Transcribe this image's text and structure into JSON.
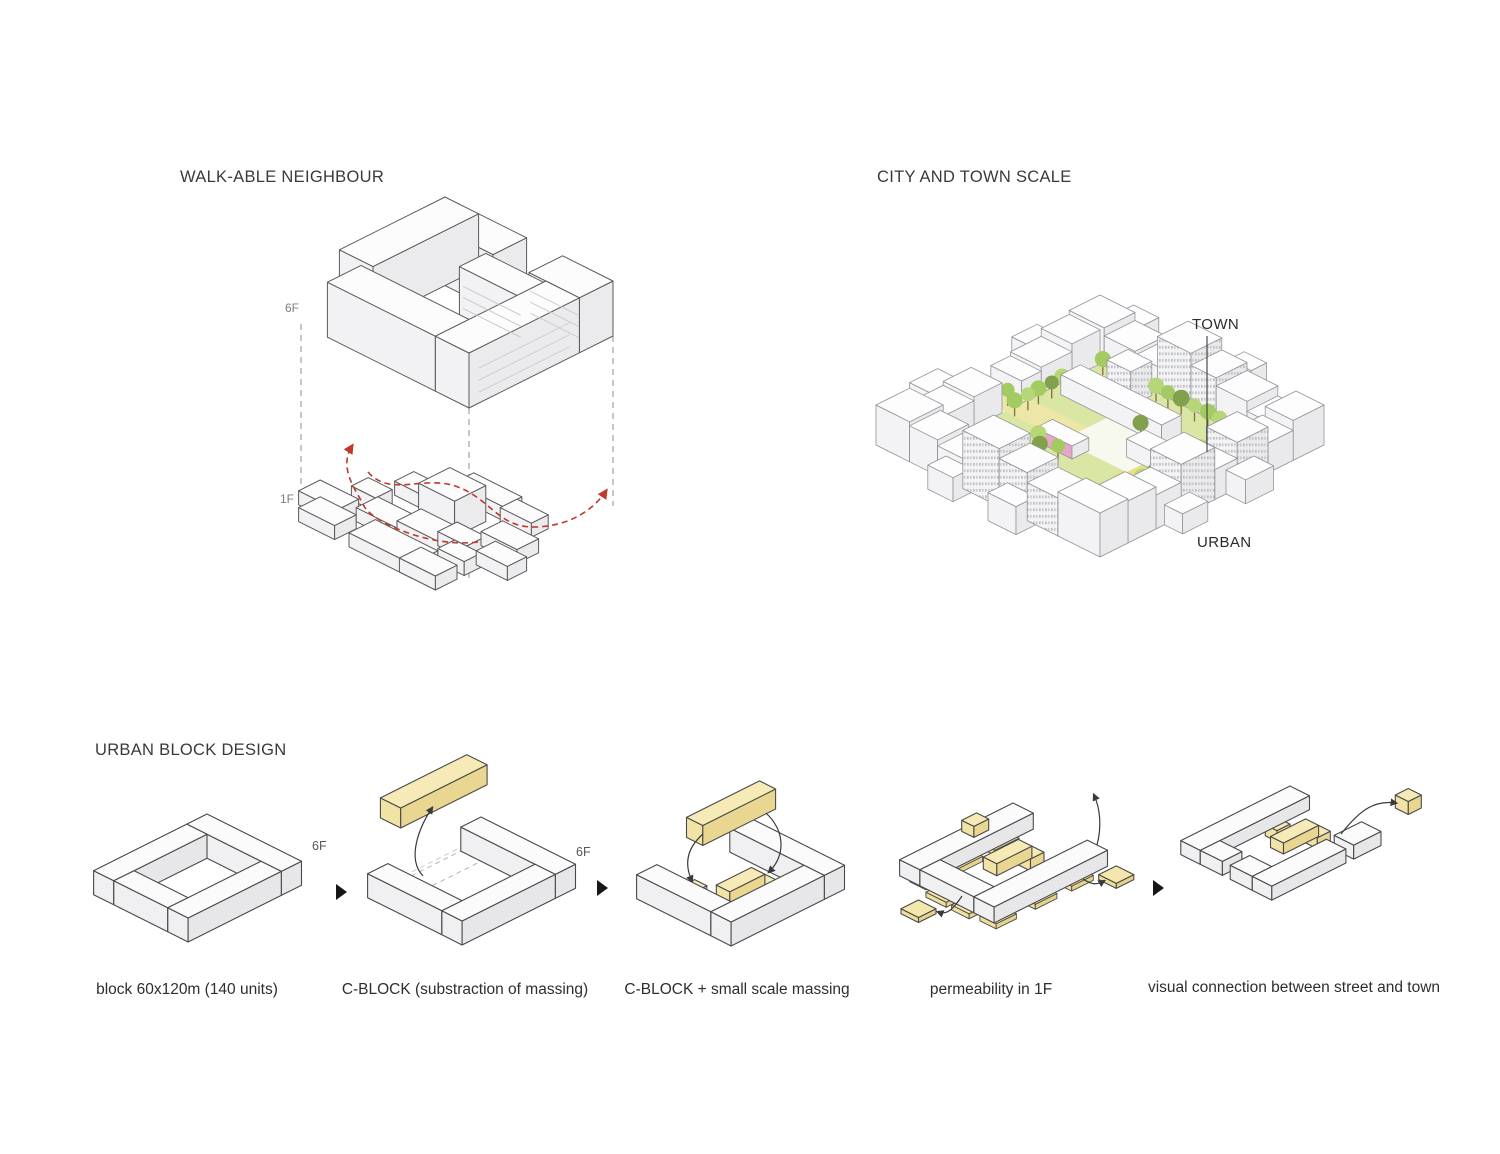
{
  "page": {
    "background": "#ffffff"
  },
  "sections": {
    "walkable": {
      "title": "WALK-ABLE NEIGHBOUR",
      "floor_labels": {
        "upper": "6F",
        "lower": "1F"
      },
      "flow_color": "#c0392b"
    },
    "city": {
      "title": "CITY AND TOWN SCALE",
      "labels": {
        "inner": "TOWN",
        "outer": "URBAN"
      },
      "palette": {
        "tree_light": "#b6d677",
        "tree_dark": "#82a14d",
        "lawn": "#d9e6a4",
        "path_yellow": "#ece7a6",
        "accent_pink": "#e6a6c8",
        "building_top": "#fdfdfe"
      }
    },
    "urban_block": {
      "title": "URBAN BLOCK DESIGN",
      "accent_yellow": "#f5e9b4",
      "steps": [
        {
          "caption": "block 60x120m (140 units)",
          "floor_label": "6F"
        },
        {
          "caption": "C-BLOCK (substraction of massing)",
          "floor_label": "6F"
        },
        {
          "caption": "C-BLOCK + small scale massing"
        },
        {
          "caption": "permeability in 1F"
        },
        {
          "caption": "visual connection between street and  town"
        }
      ]
    }
  }
}
